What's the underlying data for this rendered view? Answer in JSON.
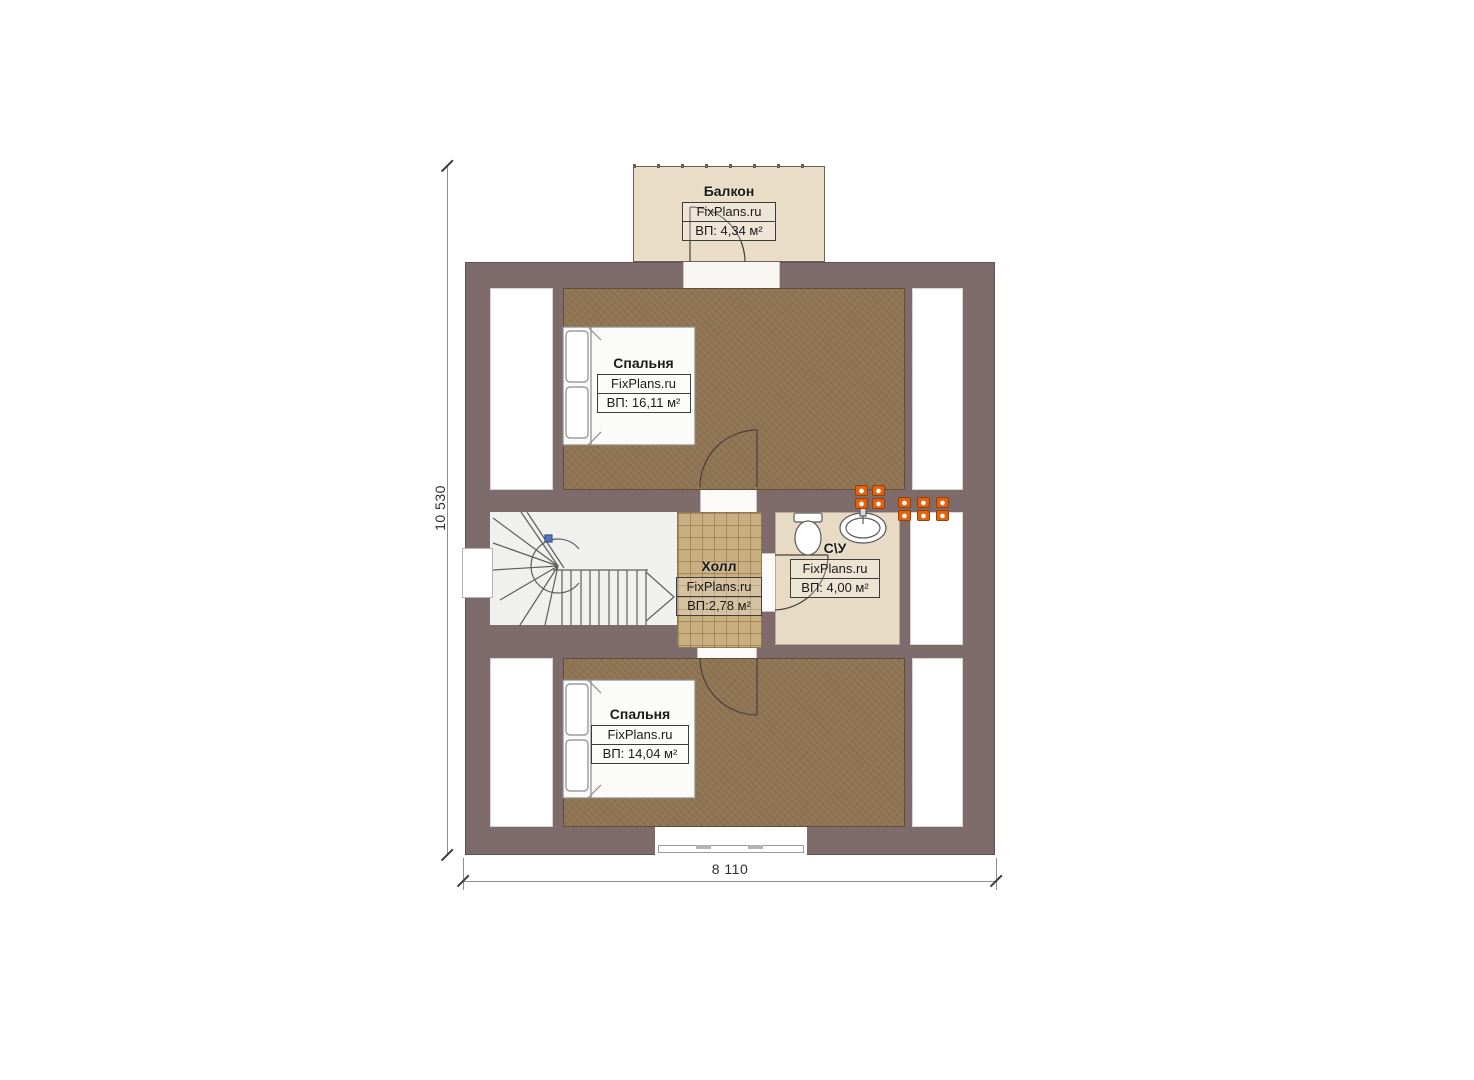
{
  "watermark": "FixPlans.ru",
  "dimensions": {
    "height": "10 530",
    "width": "8 110"
  },
  "rooms": {
    "balcony": {
      "name": "Балкон",
      "brand": "FixPlans.ru",
      "area": "ВП: 4,34 м²"
    },
    "bedroom_top": {
      "name": "Спальня",
      "brand": "FixPlans.ru",
      "area": "ВП: 16,11 м²"
    },
    "hall": {
      "name": "Холл",
      "brand": "FixPlans.ru",
      "area": "ВП:2,78 м²"
    },
    "bathroom": {
      "name": "С\\У",
      "brand": "FixPlans.ru",
      "area": "ВП: 4,00 м²"
    },
    "bedroom_bottom": {
      "name": "Спальня",
      "brand": "FixPlans.ru",
      "area": "ВП: 14,04 м²"
    }
  },
  "colors": {
    "wall": "#7e6c6d",
    "floor_wood": "#8d7352",
    "floor_tile": "#c9ae80",
    "floor_bath": "#e8dbc5",
    "floor_balcony": "#eaddc8",
    "fixture_orange": "#e2620f",
    "dimension_text": "#2e2e2e"
  }
}
